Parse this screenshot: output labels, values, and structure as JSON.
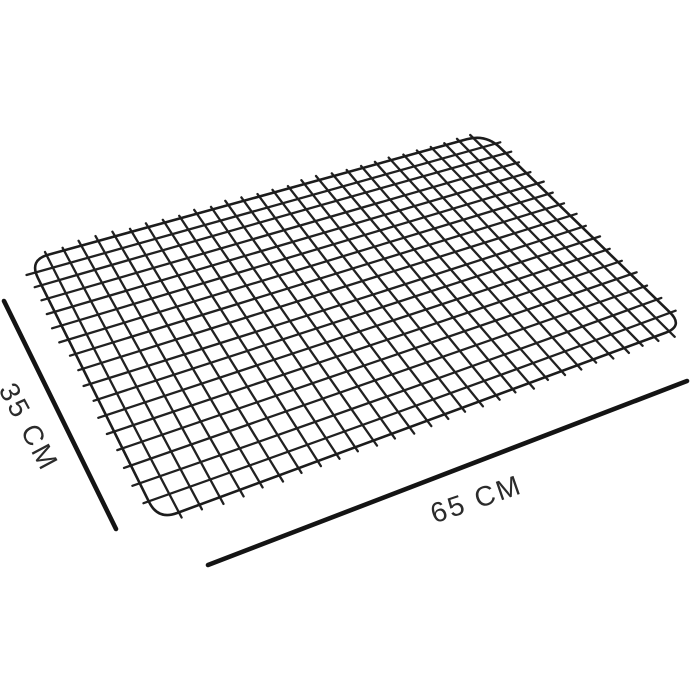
{
  "diagram": {
    "labels": {
      "depth": "35 CM",
      "width": "65 CM"
    },
    "grid": {
      "columns": 30,
      "rows": 17
    },
    "colors": {
      "wire": "#212121",
      "border": "#1c1c1c",
      "dimension_line": "#141414",
      "label_text": "#2b2b2b",
      "background": "#ffffff"
    }
  }
}
